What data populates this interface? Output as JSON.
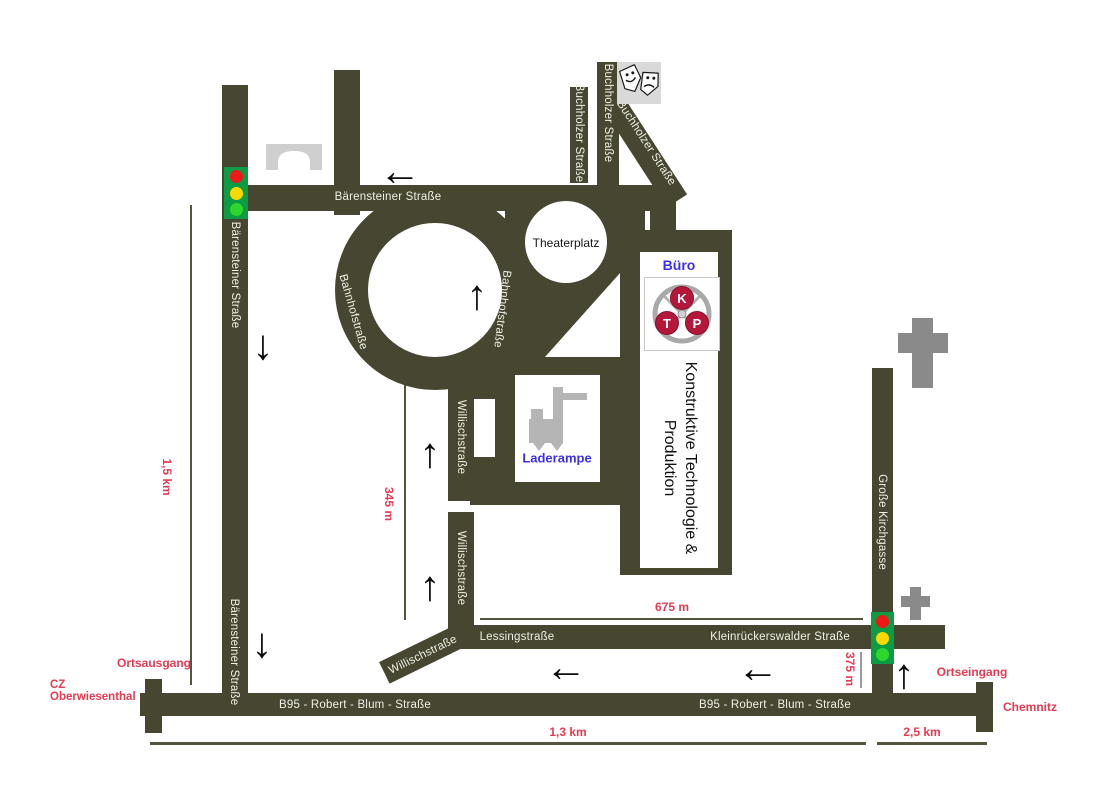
{
  "colors": {
    "road": "#474731",
    "distance_red": "#e9384f",
    "place_blue": "#3c2ff0",
    "street_text": "#f0f0e6",
    "traffic_light_housing": "#0c9c44",
    "signal_red": "#f01818",
    "signal_yellow": "#ffd800",
    "signal_green": "#2ed62e",
    "icon_gray": "#8a8a8a",
    "bridge_gray": "#cfcfcf",
    "forklift_gray": "#b5b5b5",
    "logo_red": "#b5173a"
  },
  "streets": {
    "baerensteiner": "Bärensteiner Straße",
    "buchholzer": "Buchholzer Straße",
    "bahnhofstrasse": "Bahnhofstraße",
    "willischstrasse": "Willischstraße",
    "lessingstrasse": "Lessingstraße",
    "kleinrueckerswalder": "Kleinrückerswalder Straße",
    "b95": "B95 - Robert - Blum - Straße",
    "grosse_kirchgasse": "Große Kirchgasse",
    "theaterplatz": "Theaterplatz"
  },
  "company": {
    "office": "Büro",
    "name_line1": "Konstruktive Technologie &",
    "name_line2": "Produktion",
    "loading_dock": "Laderampe",
    "logo_k": "K",
    "logo_t": "T",
    "logo_p": "P"
  },
  "distances": {
    "baerensteiner_south": "1,5 km",
    "willisch": "345 m",
    "kleinrueckerswalder": "675 m",
    "kirchgasse_south": "375 m",
    "b95_west": "1,3 km",
    "b95_east": "2,5 km"
  },
  "endpoints": {
    "ortsausgang": "Ortsausgang",
    "cz_line1": "CZ",
    "cz_line2": "Oberwiesenthal",
    "ortseingang": "Ortseingang",
    "chemnitz": "Chemnitz"
  },
  "icons": {
    "arrow_left": "←",
    "arrow_up": "↑",
    "arrow_down": "↓"
  }
}
